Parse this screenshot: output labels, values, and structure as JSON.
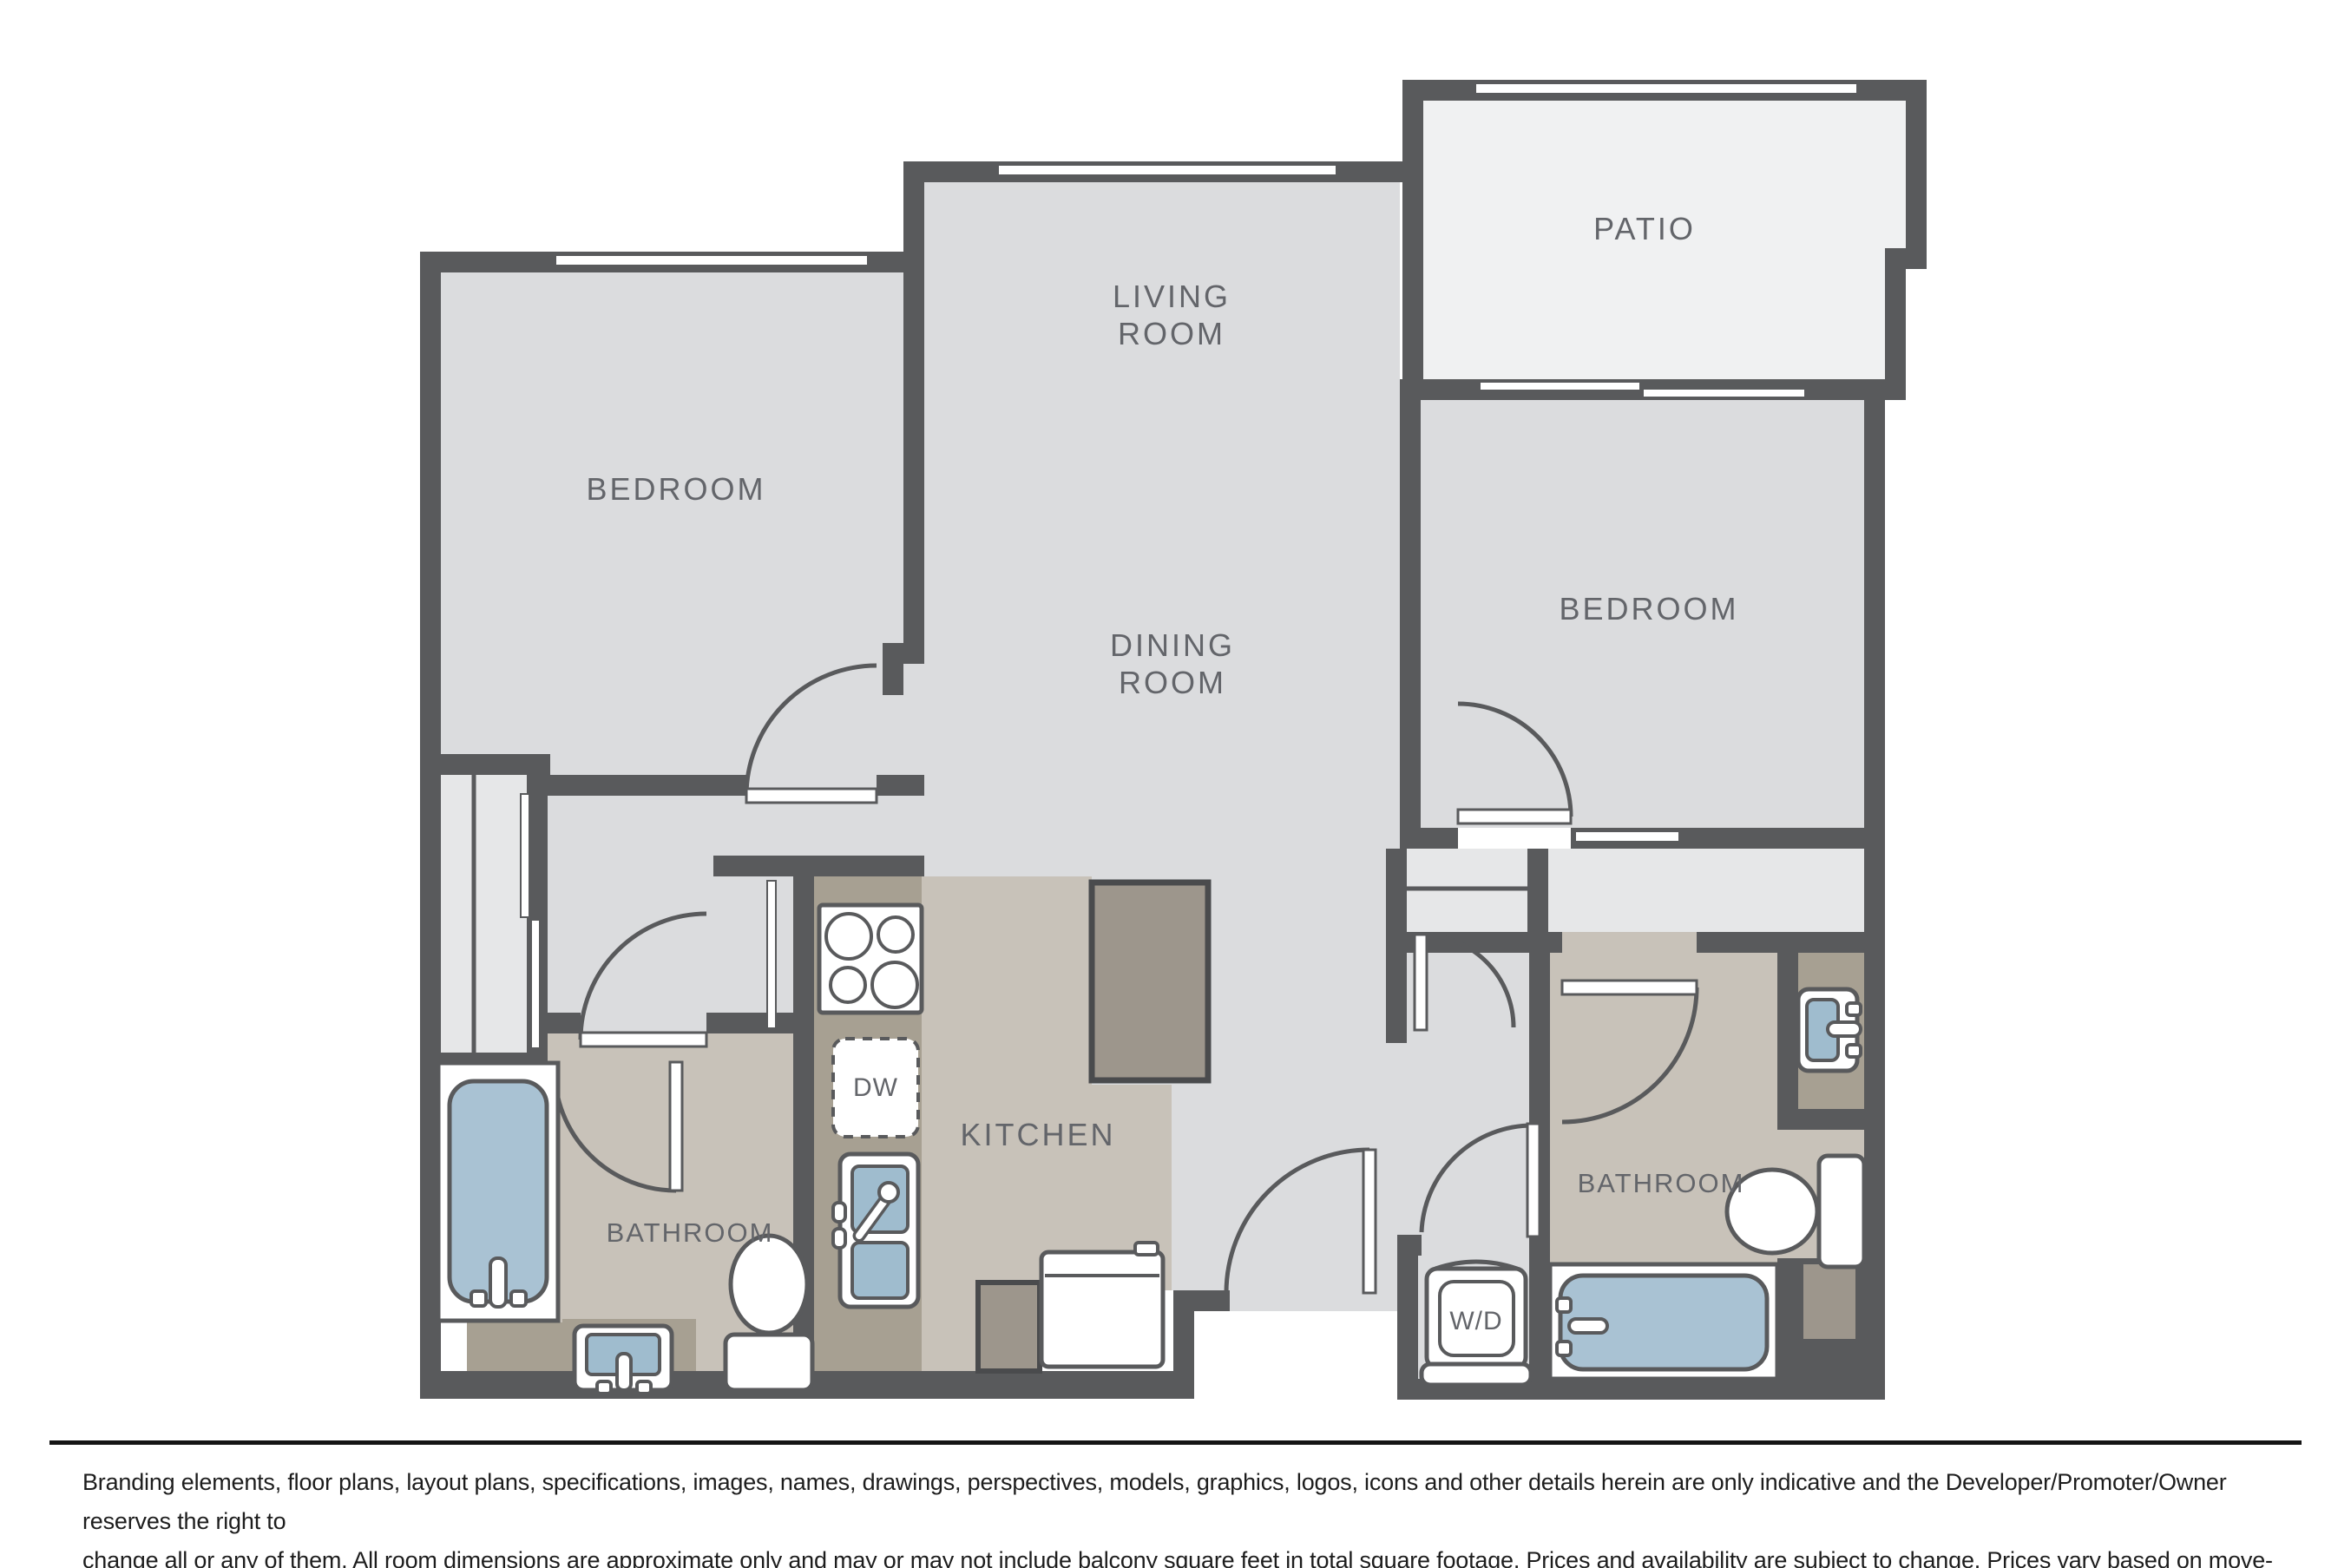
{
  "floorplan": {
    "rooms": {
      "patio": "PATIO",
      "living_line1": "LIVING",
      "living_line2": "ROOM",
      "dining_line1": "DINING",
      "dining_line2": "ROOM",
      "bedroom_left": "BEDROOM",
      "bedroom_right": "BEDROOM",
      "kitchen": "KITCHEN",
      "bathroom_left": "BATHROOM",
      "bathroom_right": "BATHROOM"
    },
    "appliances": {
      "dishwasher": "DW",
      "washer_dryer": "W/D"
    },
    "colors": {
      "wall": "#595A5C",
      "room_floor": "#DBDCDE",
      "patio_floor": "#F0F1F2",
      "closet_floor": "#E6E7E8",
      "bath_kitchen_floor": "#C8C2B9",
      "counter": "#A7A092",
      "island": "#9D968C",
      "fixture_blue": "#A9C2D3",
      "label_text": "#63656A"
    }
  },
  "disclaimer": {
    "line1": "Branding elements, floor plans, layout plans, specifications, images, names, drawings, perspectives, models, graphics, logos, icons and other details herein are only indicative and the Developer/Promoter/Owner reserves the right to",
    "line2": "change all or any of them. All room dimensions are approximate only and may or may not include balcony square feet in total square footage. Prices and availability are subject to change. Prices vary based on move-in and lease terms."
  }
}
